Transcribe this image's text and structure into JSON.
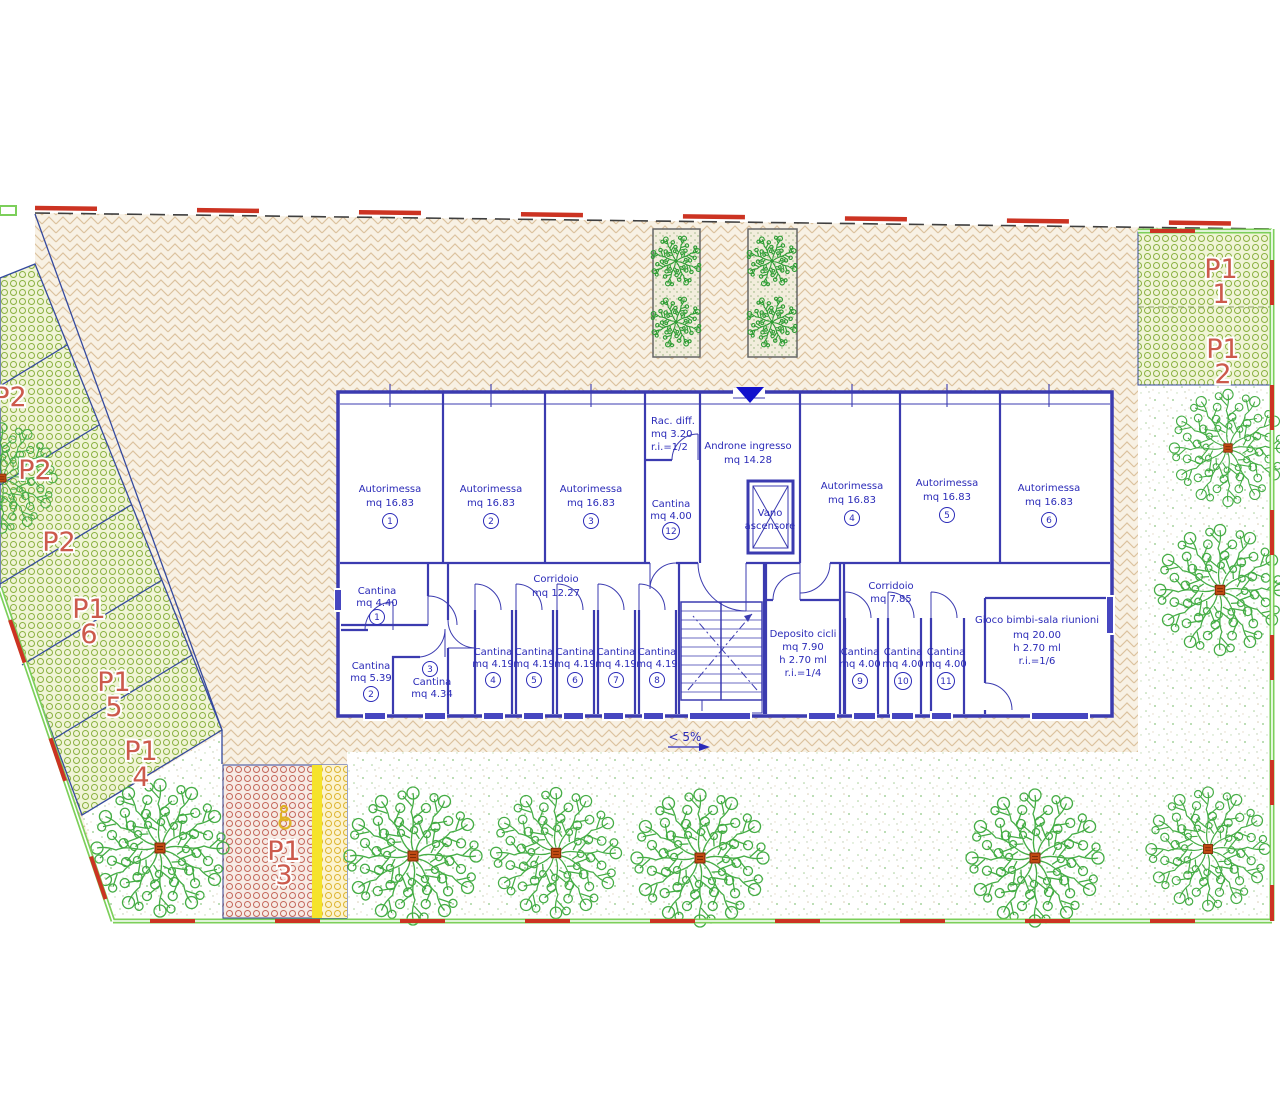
{
  "plan": {
    "slope_label": "< 5%",
    "colors": {
      "wall_blue": "#3b3bb0",
      "room_text_blue": "#2a2ab8",
      "parking_label_red": "#cc5a4c",
      "boundary_green": "#7ccf5a",
      "boundary_red": "#cc3322",
      "tree_green": "#45ad45",
      "trunk_brown": "#c04a12",
      "entrance_marker_blue": "#1111cc",
      "disabled_stripe_yellow": "#f5e32a",
      "paving_beige": "#f8f1e4",
      "parking_hatch_green": "#8ab141"
    },
    "rooms": [
      {
        "name": "Autorimessa",
        "area": "mq 16.83",
        "num": "1"
      },
      {
        "name": "Autorimessa",
        "area": "mq 16.83",
        "num": "2"
      },
      {
        "name": "Autorimessa",
        "area": "mq 16.83",
        "num": "3"
      },
      {
        "name": "Rac. diff.",
        "area": "mq 3.20",
        "ri": "r.i.=1/2"
      },
      {
        "name": "Androne ingresso",
        "area": "mq 14.28"
      },
      {
        "name": "Cantina",
        "area": "mq 4.00",
        "num": "12"
      },
      {
        "name": "Vano",
        "name2": "ascensore"
      },
      {
        "name": "Autorimessa",
        "area": "mq 16.83",
        "num": "4"
      },
      {
        "name": "Autorimessa",
        "area": "mq 16.83",
        "num": "5"
      },
      {
        "name": "Autorimessa",
        "area": "mq 16.83",
        "num": "6"
      },
      {
        "name": "Corridoio",
        "area": "mq 12.27"
      },
      {
        "name": "Cantina",
        "area": "mq 4.40",
        "num": "1"
      },
      {
        "name": "Cantina",
        "area": "mq 5.39",
        "num": "2"
      },
      {
        "name": "Cantina",
        "area": "mq 4.34",
        "num": "3"
      },
      {
        "name": "Cantina",
        "area": "mq 4.19",
        "num": "4"
      },
      {
        "name": "Cantina",
        "area": "mq 4.19",
        "num": "5"
      },
      {
        "name": "Cantina",
        "area": "mq 4.19",
        "num": "6"
      },
      {
        "name": "Cantina",
        "area": "mq 4.19",
        "num": "7"
      },
      {
        "name": "Cantina",
        "area": "mq 4.19",
        "num": "8"
      },
      {
        "name": "Deposito cicli",
        "area": "mq 7.90",
        "h": "h 2.70 ml",
        "ri": "r.i.=1/4"
      },
      {
        "name": "Corridoio",
        "area": "mq 7.85"
      },
      {
        "name": "Cantina",
        "area": "mq 4.00",
        "num": "9"
      },
      {
        "name": "Cantina",
        "area": "mq 4.00",
        "num": "10"
      },
      {
        "name": "Cantina",
        "area": "mq 4.00",
        "num": "11"
      },
      {
        "name": "Gioco bimbi-sala riunioni",
        "area": "mq 20.00",
        "h": "h 2.70 ml",
        "ri": "r.i.=1/6"
      }
    ],
    "parking": {
      "left_stalls": [
        {
          "label": "P2"
        },
        {
          "label": "P2"
        },
        {
          "label": "P2"
        },
        {
          "label": "P1",
          "num": "6"
        },
        {
          "label": "P1",
          "num": "5"
        },
        {
          "label": "P1",
          "num": "4"
        }
      ],
      "right_stalls": [
        {
          "label": "P1",
          "num": "1"
        },
        {
          "label": "P1",
          "num": "2"
        }
      ],
      "disabled_stall": {
        "label": "P1",
        "num": "3"
      }
    }
  }
}
